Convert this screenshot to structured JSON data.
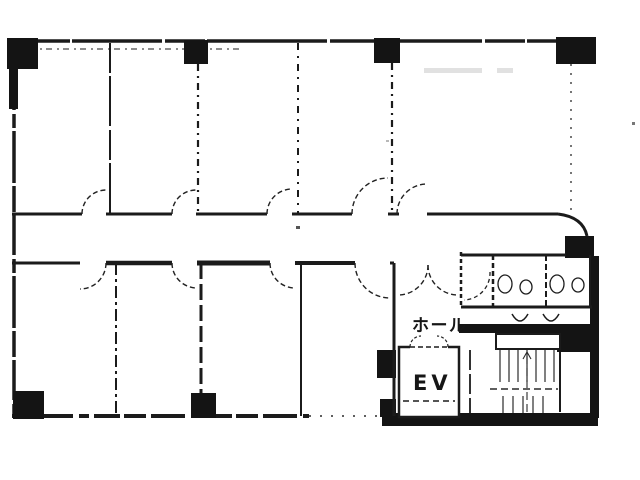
{
  "plan": {
    "labels": {
      "hall": "ホール",
      "elevator": "EV"
    },
    "colors": {
      "ink": "#1b1b1b",
      "paper": "#ffffff"
    }
  }
}
